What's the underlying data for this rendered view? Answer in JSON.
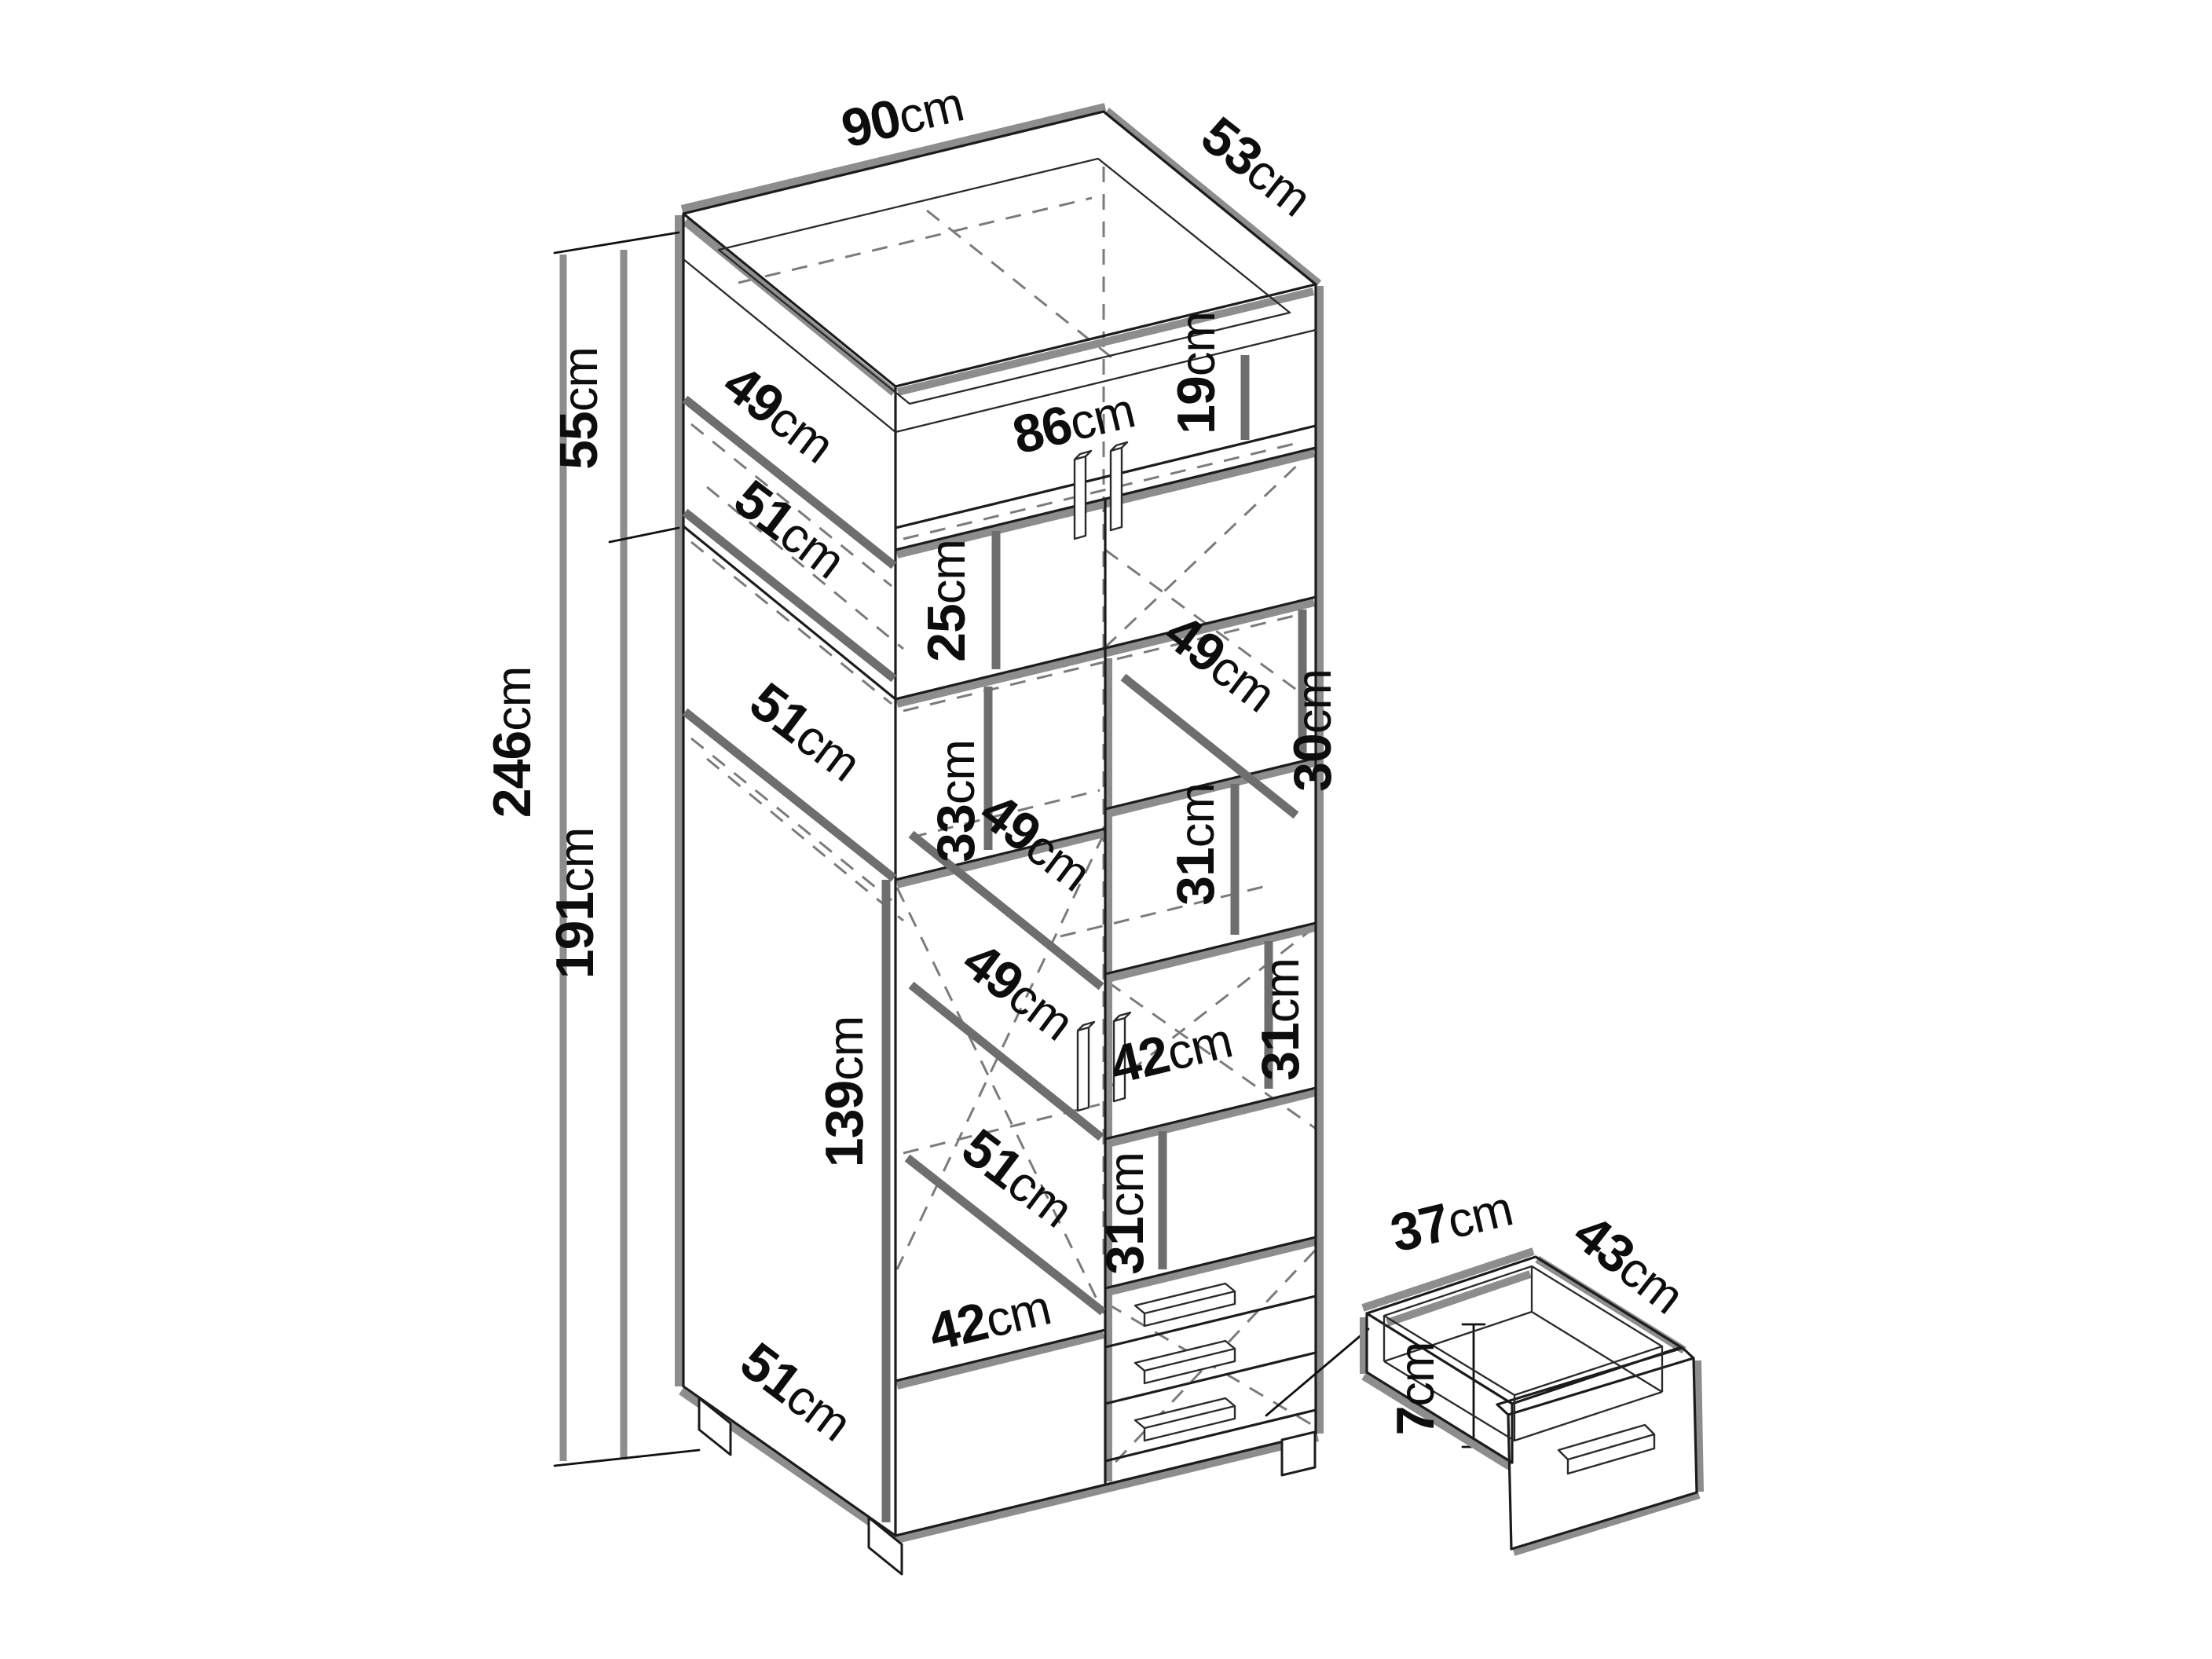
{
  "figure": {
    "type": "furniture-dimension-diagram",
    "subject": "tall wardrobe cabinet line drawing with dimension labels and detached drawer detail",
    "unit": "cm",
    "background": "#ffffff",
    "line_color": "#1c1c1c",
    "shadow_color": "#8d8d8d",
    "dash_color": "#7b7b7b",
    "label_color": "#0d0d0d"
  },
  "cabinet": {
    "width": "90 cm",
    "depth": "53 cm",
    "total_height": "246 cm",
    "top_section_height": "55 cm",
    "lower_section_height": "191 cm",
    "hanging_space_height": "139 cm",
    "interior_width": "86 cm",
    "drawer_count": 3,
    "door_count": 4
  },
  "drawer_detail": {
    "width": "37 cm",
    "depth": "43 cm",
    "height": "7 cm"
  },
  "labels": [
    {
      "id": "cabinet-width",
      "value": "90",
      "unit": "cm"
    },
    {
      "id": "cabinet-depth",
      "value": "53",
      "unit": "cm"
    },
    {
      "id": "top-section-height",
      "value": "55",
      "unit": "cm"
    },
    {
      "id": "total-height",
      "value": "246",
      "unit": "cm"
    },
    {
      "id": "lower-section-height",
      "value": "191",
      "unit": "cm"
    },
    {
      "id": "top-shelf-depth",
      "value": "49",
      "unit": "cm"
    },
    {
      "id": "upper-shelf-depth",
      "value": "51",
      "unit": "cm"
    },
    {
      "id": "interior-width",
      "value": "86",
      "unit": "cm"
    },
    {
      "id": "top-niche-height",
      "value": "19",
      "unit": "cm"
    },
    {
      "id": "upper-door-height",
      "value": "25",
      "unit": "cm"
    },
    {
      "id": "right-niche-shelf-depth",
      "value": "49",
      "unit": "cm"
    },
    {
      "id": "right-niche-height",
      "value": "30",
      "unit": "cm"
    },
    {
      "id": "middle-shelf-depth",
      "value": "51",
      "unit": "cm"
    },
    {
      "id": "interior-shelf-spacing",
      "value": "33",
      "unit": "cm"
    },
    {
      "id": "shelf-depth-49a",
      "value": "49",
      "unit": "cm"
    },
    {
      "id": "shelf-depth-49b",
      "value": "49",
      "unit": "cm"
    },
    {
      "id": "shelf-spacing-31a",
      "value": "31",
      "unit": "cm"
    },
    {
      "id": "shelf-spacing-31b",
      "value": "31",
      "unit": "cm"
    },
    {
      "id": "right-interior-width",
      "value": "42",
      "unit": "cm"
    },
    {
      "id": "shelf-spacing-31c",
      "value": "31",
      "unit": "cm"
    },
    {
      "id": "hanging-height",
      "value": "139",
      "unit": "cm"
    },
    {
      "id": "lower-shelf-depth",
      "value": "51",
      "unit": "cm"
    },
    {
      "id": "left-interior-width",
      "value": "42",
      "unit": "cm"
    },
    {
      "id": "bottom-depth",
      "value": "51",
      "unit": "cm"
    },
    {
      "id": "drawer-width",
      "value": "37",
      "unit": "cm"
    },
    {
      "id": "drawer-depth",
      "value": "43",
      "unit": "cm"
    },
    {
      "id": "drawer-height",
      "value": "7",
      "unit": "cm"
    }
  ]
}
